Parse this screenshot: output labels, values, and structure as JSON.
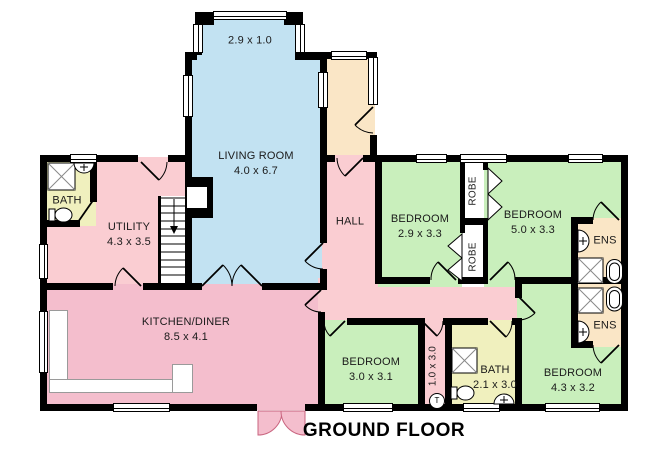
{
  "title": "GROUND FLOOR",
  "colors": {
    "wall": "#000000",
    "living_room": "#c2e2f2",
    "bedroom": "#c9efbc",
    "bathroom": "#f0f0be",
    "ensuite_porch": "#fae6c6",
    "hall_utility": "#facdd2",
    "kitchen": "#f4becd"
  },
  "rooms": {
    "living": {
      "name": "LIVING ROOM",
      "dims": "4.0 x 6.7"
    },
    "bay": {
      "dims": "2.9 x 1.0"
    },
    "utility": {
      "name": "UTILITY",
      "dims": "4.3 x 3.5"
    },
    "bath1": {
      "name": "BATH"
    },
    "hall": {
      "name": "HALL"
    },
    "kitchen": {
      "name": "KITCHEN/DINER",
      "dims": "8.5 x 4.1"
    },
    "bedroom1": {
      "name": "BEDROOM",
      "dims": "2.9 x 3.3"
    },
    "bedroom2": {
      "name": "BEDROOM",
      "dims": "5.0 x 3.3"
    },
    "bedroom3": {
      "name": "BEDROOM",
      "dims": "3.0 x 3.1"
    },
    "bedroom4": {
      "name": "BEDROOM",
      "dims": "4.3 x 3.2"
    },
    "bath2": {
      "name": "BATH",
      "dims": "2.1 x 3.0"
    },
    "ens1": {
      "name": "ENS"
    },
    "ens2": {
      "name": "ENS"
    },
    "robe1": {
      "name": "ROBE"
    },
    "robe2": {
      "name": "ROBE"
    },
    "corridor": {
      "dims": "1.0 x 3.0"
    },
    "tank": {
      "label": "T"
    }
  }
}
